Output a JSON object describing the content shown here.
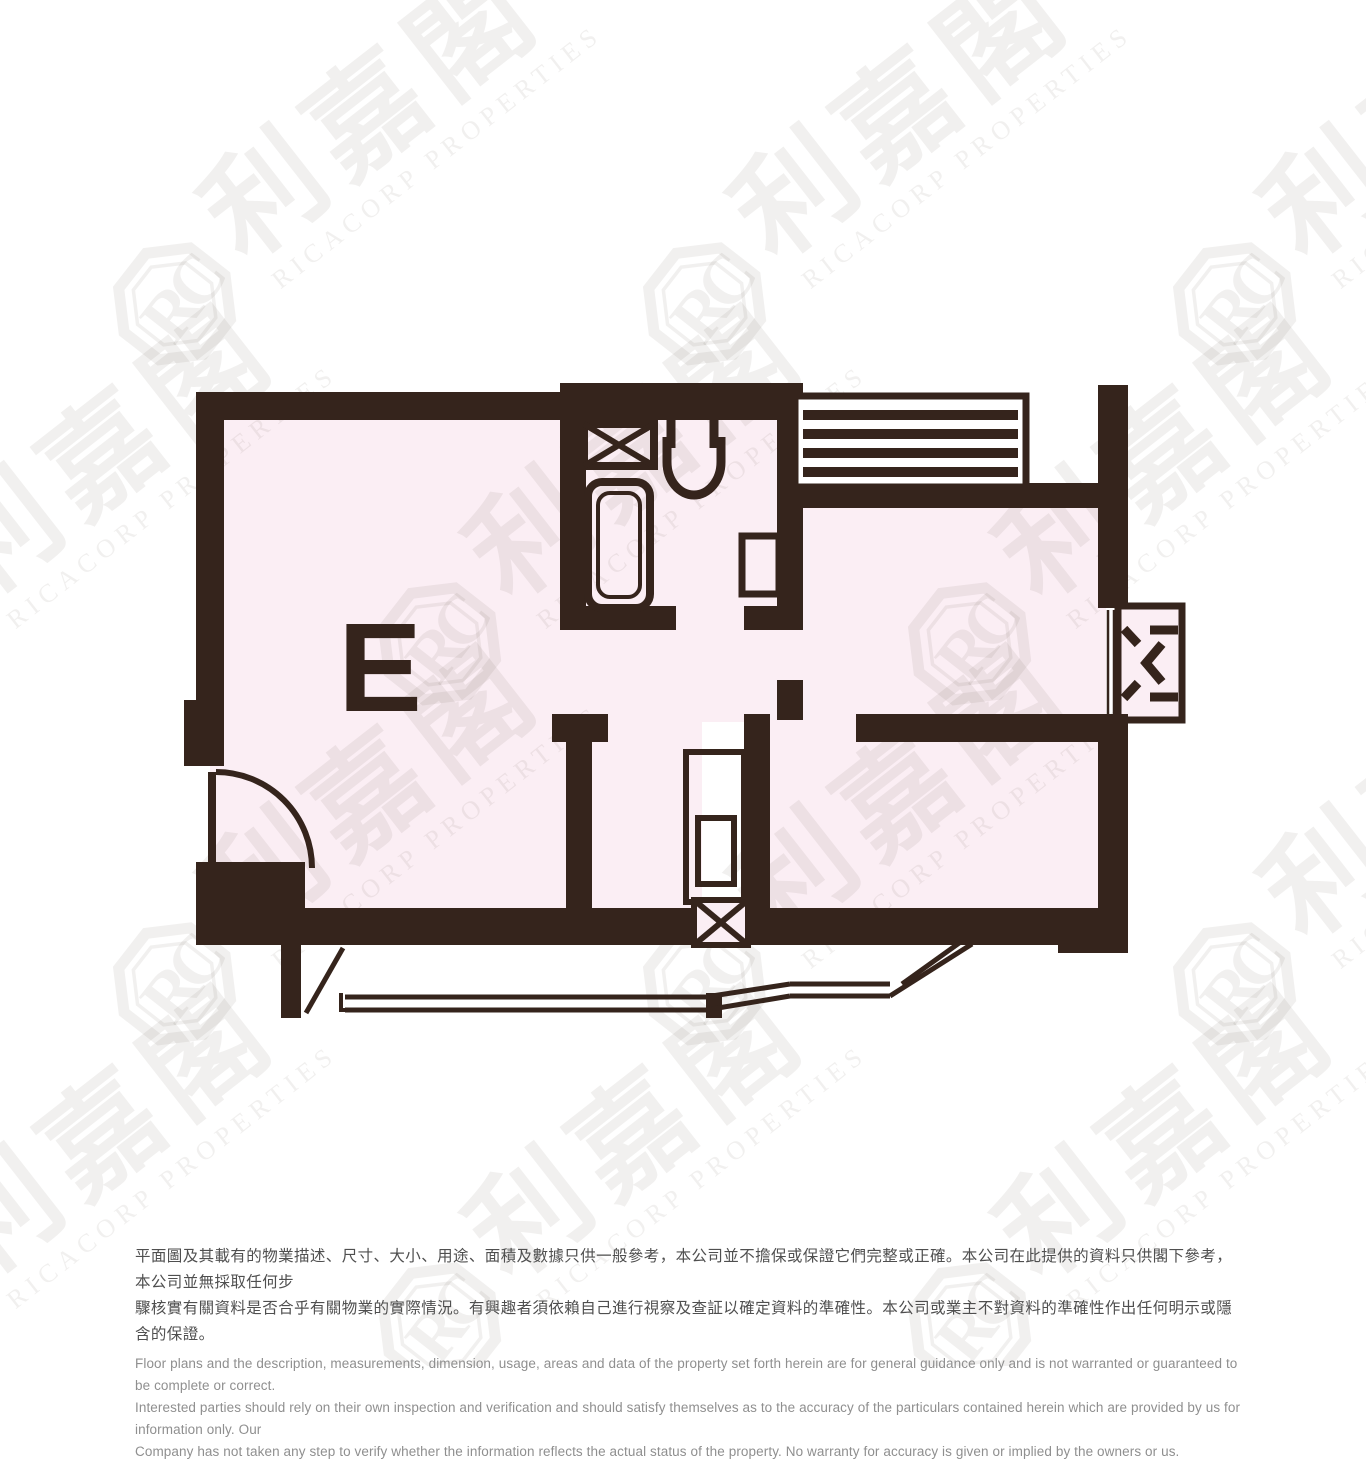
{
  "page": {
    "background_color": "#ffffff"
  },
  "floor_plan": {
    "unit_label": "E",
    "wall_color": "#35241c",
    "floor_color": "#fbeef4",
    "elements": [
      "living-dining-room",
      "bathroom",
      "bathtub",
      "toilet",
      "washbasin",
      "obscured-window-x",
      "louver-platform",
      "bedroom-1",
      "bedroom-2",
      "kitchen",
      "kitchen-cabinet",
      "kitchen-window-x",
      "air-conditioner-box",
      "entrance-door",
      "bay-window"
    ]
  },
  "watermark": {
    "logo_text": "RC",
    "chinese_text": "利嘉閣",
    "caption": "RICACORP PROPERTIES",
    "color": "rgba(53,36,28,0.07)"
  },
  "disclaimer": {
    "chinese": "平面圖及其載有的物業描述、尺寸、大小、用途、面積及數據只供一般參考，本公司並不擔保或保證它們完整或正確。本公司在此提供的資料只供閣下參考，本公司並無採取任何步\n驟核實有關資料是否合乎有關物業的實際情況。有興趣者須依賴自己進行視察及查証以確定資料的準確性。本公司或業主不對資料的準確性作出任何明示或隱含的保證。",
    "english": "Floor plans and the description, measurements, dimension, usage, areas and data of the property set forth herein are for general guidance only and is not warranted or guaranteed to be complete or correct.\nInterested parties should rely on their own inspection and verification and should satisfy themselves as to the accuracy of the particulars contained herein which are provided by us for information only.  Our\nCompany has not taken any step to verify whether the information reflects the actual status of the property.  No warranty for accuracy is given or implied by the owners or us.",
    "chinese_color": "#4f4f4f",
    "english_color": "#8f8f8f"
  }
}
